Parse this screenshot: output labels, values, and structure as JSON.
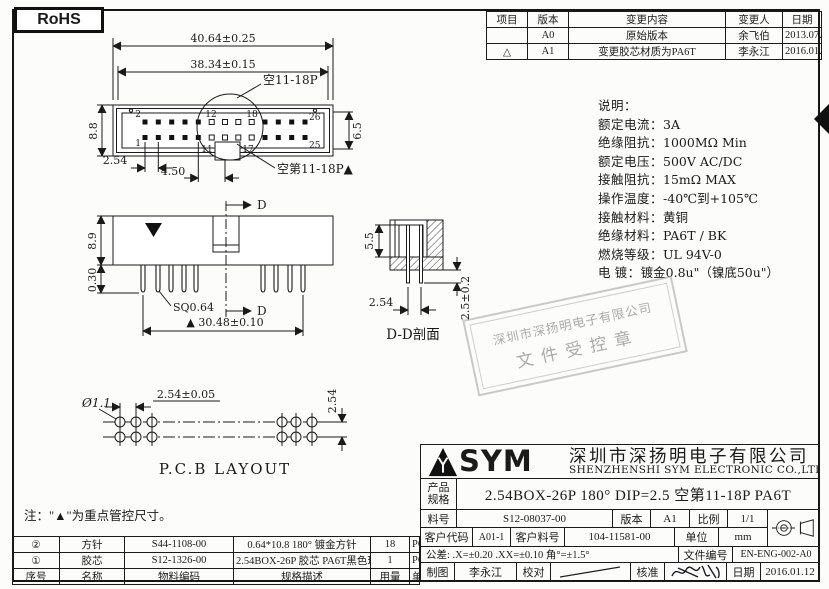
{
  "page": {
    "rohs": "RoHS",
    "note": "注：\"▲\"为重点管控尺寸。"
  },
  "revision_table": {
    "headers": {
      "item": "项目",
      "version": "版本",
      "content": "变更内容",
      "changer": "变更人",
      "date": "日期"
    },
    "rows": [
      {
        "item": "",
        "version": "A0",
        "content": "原始版本",
        "changer": "余飞伯",
        "date": "2013.07.26"
      },
      {
        "item": "△",
        "version": "A1",
        "content": "变更胶芯材质为PA6T",
        "changer": "李永江",
        "date": "2016.01.12"
      }
    ]
  },
  "specs": {
    "title": "说明：",
    "items": [
      {
        "label": "额定电流：",
        "value": "3A"
      },
      {
        "label": "绝缘阻抗：",
        "value": "1000MΩ Min"
      },
      {
        "label": "额定电压：",
        "value": "500V AC/DC"
      },
      {
        "label": "接触阻抗：",
        "value": "15mΩ MAX"
      },
      {
        "label": "操作温度：",
        "value": "-40℃到+105℃"
      },
      {
        "label": "接触材料：",
        "value": "黄铜"
      },
      {
        "label": "绝缘材料：",
        "value": "PA6T / BK"
      },
      {
        "label": "燃烧等级：",
        "value": "UL 94V-0"
      },
      {
        "label": "电    镀：",
        "value": "镀金0.8u\"（镍底50u\"）"
      }
    ]
  },
  "stamp": {
    "line1": "深圳市深扬明电子有限公司",
    "line2": "文件受控章"
  },
  "drawings": {
    "top_view": {
      "dim_overall": "40.64±0.25",
      "dim_inner": "38.34±0.15",
      "callout_top": "空11-18P",
      "callout_bottom": "空第11-18P▲",
      "dim_h_left": "8.8",
      "dim_h_right": "6.5",
      "dim_pitch": "2.54",
      "dim_gap": "4.50",
      "pin_top_first": "2",
      "pin_top_mid1": "12",
      "pin_top_mid2": "18",
      "pin_top_last": "26",
      "pin_bot_first": "1",
      "pin_bot_mid1": "11",
      "pin_bot_mid2": "17",
      "pin_bot_last": "25"
    },
    "front_view": {
      "dim_height": "8.9",
      "dim_pin_len": "0.30",
      "pin_square": "SQ0.64",
      "dim_span": "▲ 30.48±0.10",
      "section_label": "D"
    },
    "section_view": {
      "dim_depth": "5.5",
      "dim_pitch": "2.54",
      "dim_protrusion": "2.5±0.2",
      "title": "D-D剖面"
    },
    "pcb": {
      "hole_dia": "Ø1.1",
      "dim_pitch": "2.54±0.05",
      "dim_row": "2.54",
      "title": "P.C.B LAYOUT"
    }
  },
  "bom": {
    "headers": {
      "no": "序号",
      "name": "名称",
      "code": "物料编码",
      "desc": "规格描述",
      "qty": "用量",
      "unit": "单位"
    },
    "rows": [
      {
        "no": "②",
        "name": "方针",
        "code": "S44-1108-00",
        "desc": "0.64*10.8 180° 镀金方针",
        "qty": "18",
        "unit": "PCS"
      },
      {
        "no": "①",
        "name": "胶芯",
        "code": "S12-1326-00",
        "desc": "2.54BOX-26P 胶芯 PA6T黑色环保 △",
        "qty": "1",
        "unit": "PCS"
      }
    ]
  },
  "title_block": {
    "logo_text": "SYM",
    "company_cn": "深圳市深扬明电子有限公司",
    "company_en": "SHENZHENSHI SYM ELECTRONIC CO.,LTD",
    "product_label1": "产品",
    "product_label2": "规格",
    "product_value": "2.54BOX-26P  180° DIP=2.5 空第11-18P PA6T",
    "part_label": "料号",
    "part_value": "S12-08037-00",
    "version_label": "版本",
    "version_value": "A1",
    "scale_label": "比例",
    "scale_value": "1/1",
    "customer_code_label": "客户代码",
    "customer_code_value": "A01-1",
    "customer_part_label": "客户料号",
    "customer_part_value": "104-11581-00",
    "unit_label": "单位",
    "unit_value": "mm",
    "tolerance": "公差: .X=±0.20  .XX=±0.10  角°=±1.5°",
    "doc_no_label": "文件编号",
    "doc_no_value": "EN-ENG-002-A0",
    "draw_label": "制图",
    "draw_value": "李永江",
    "check_label": "校对",
    "approve_label": "核准",
    "date_label": "日期",
    "date_value": "2016.01.12"
  }
}
